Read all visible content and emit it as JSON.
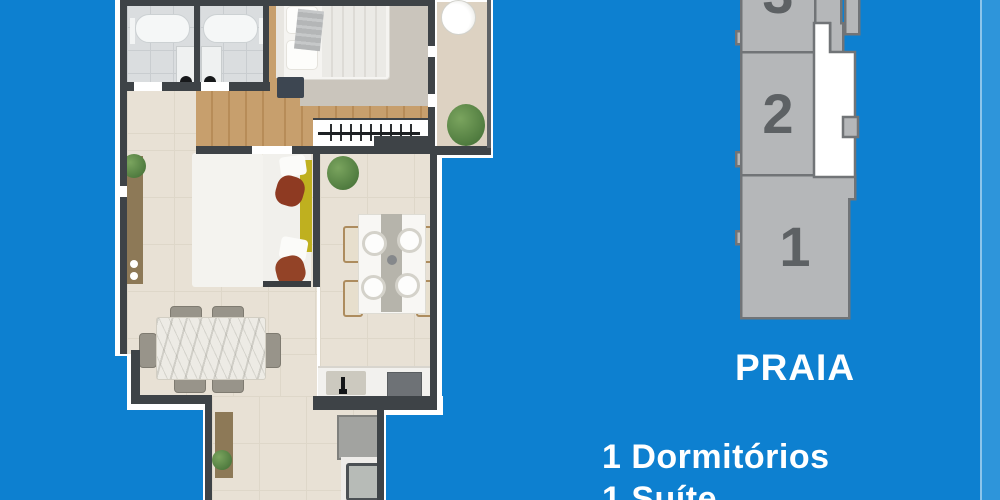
{
  "key_plan": {
    "blocks": [
      {
        "label": "3"
      },
      {
        "label": "2"
      },
      {
        "label": "1"
      }
    ],
    "unit_name": "PRAIA"
  },
  "features": {
    "line1": "1 Dormitórios",
    "line2": "1 Suíte"
  },
  "colors": {
    "background": "#0d80d0",
    "edge_stripe": "#2e95da",
    "wall": "#3e4347",
    "block_fill": "#b5b7b9",
    "block_border": "#717477",
    "block_number": "#5d6164",
    "highlight_unit": "#ffffff",
    "text": "#ffffff"
  }
}
